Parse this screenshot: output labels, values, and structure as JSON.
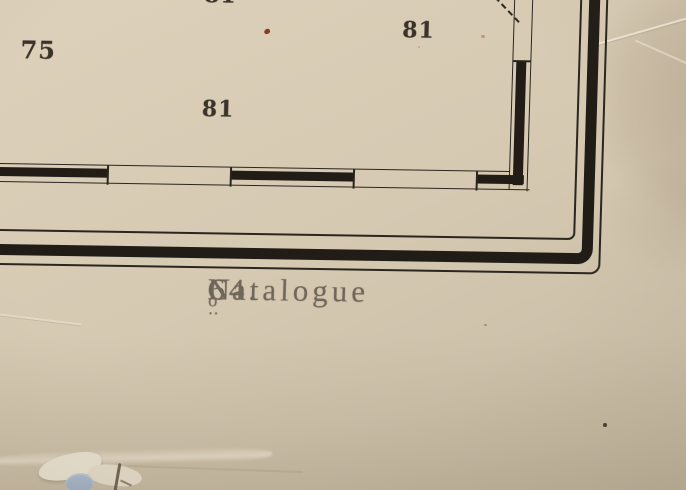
{
  "map": {
    "soundings": [
      {
        "position": "top-edge-partial",
        "value": "81"
      },
      {
        "position": "left",
        "value": "75"
      },
      {
        "position": "center",
        "value": "81"
      },
      {
        "position": "right",
        "value": "81"
      }
    ],
    "caption": {
      "word": "Catalogue",
      "numero_prefix": "N",
      "numero_sup": "o",
      "numero_marks": "‥",
      "number": "64."
    }
  },
  "colors": {
    "paper": "#d6c9b2",
    "paper_light": "#ddd1bb",
    "paper_dark": "#c6baa3",
    "ink": "#2a251f",
    "ink_strong": "#211c16",
    "sounding_ink": "#39332a",
    "caption_ink": "#6f675a",
    "stain_red": "#8a3a20",
    "tear_blue": "#9dabbd"
  }
}
